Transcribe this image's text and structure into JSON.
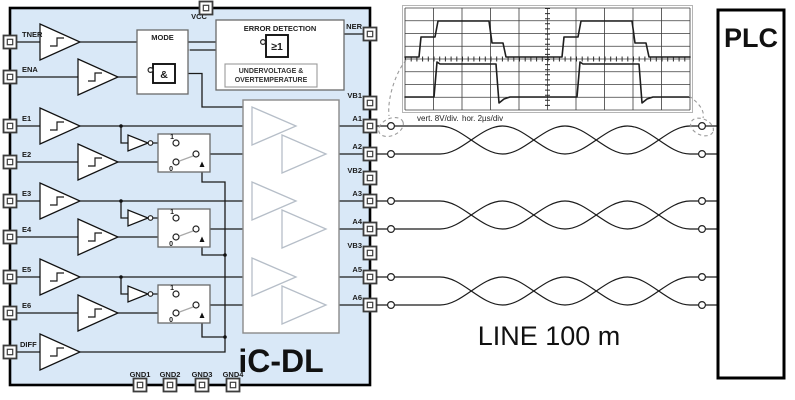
{
  "chip": {
    "name": "iC-DL",
    "fill_color": "#d9e8f7",
    "top_pins": [
      "VCC"
    ],
    "left_pins": [
      "TNER",
      "ENA",
      "E1",
      "E2",
      "E3",
      "E4",
      "E5",
      "E6",
      "DIFF"
    ],
    "right_pins": [
      "NER",
      "VB1",
      "A1",
      "A2",
      "VB2",
      "A3",
      "A4",
      "VB3",
      "A5",
      "A6"
    ],
    "bottom_pins": [
      "GND1",
      "GND2",
      "GND3",
      "GND4"
    ],
    "mode_block": {
      "title": "MODE",
      "and_gate": "&"
    },
    "error_block": {
      "title": "ERROR DETECTION",
      "or_gate": "≥1",
      "uv_line1": "UNDERVOLTAGE &",
      "uv_line2": "OVERTEMPERATURE"
    },
    "mux": {
      "one": "1",
      "zero": "0"
    }
  },
  "scope": {
    "caption_vert": "vert. 8V/div.",
    "caption_hor": "hor. 2µs/div",
    "chart_data": {
      "type": "line",
      "title": "driver differential output into 100 m line",
      "x_unit": "µs",
      "y_unit": "V",
      "x_per_div": 2,
      "y_per_div": 8,
      "divisions_x": 10,
      "divisions_y": 8,
      "grid": true,
      "series": [
        {
          "name": "upper trace (non-inverting)",
          "waveform": "square",
          "period_us": 10,
          "levels_V": [
            0,
            12,
            24,
            8,
            0
          ],
          "description": "rises ~0.5 div after cycle start with intermediate step, high ~3 div above axis, steps back down to axis"
        },
        {
          "name": "lower trace (inverting)",
          "waveform": "square",
          "period_us": 10,
          "levels_V": [
            -24,
            -1,
            -28,
            -24
          ],
          "description": "complementary trace ~3 div below axis rising to just under axis, with undershoot on falling edge"
        }
      ]
    }
  },
  "line_label": "LINE 100 m",
  "plc": {
    "label": "PLC"
  },
  "colors": {
    "chip_fill": "#d9e8f7",
    "wire": "#1b1b1b",
    "driver_outline": "#b6bec8"
  }
}
